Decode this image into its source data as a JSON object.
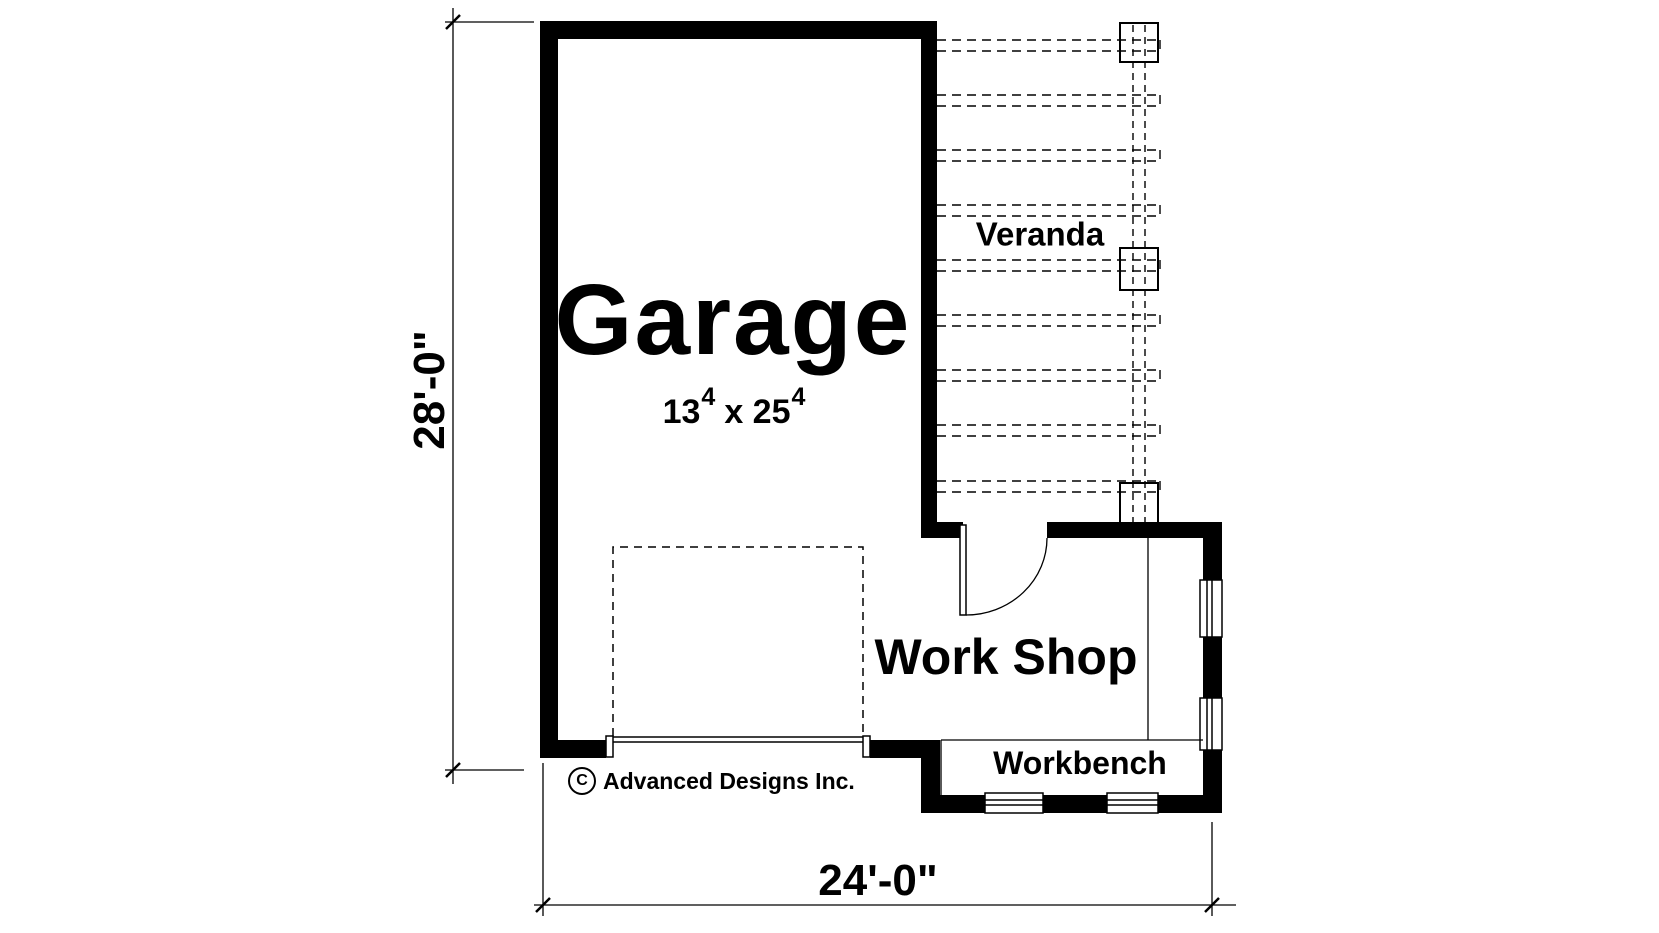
{
  "plan": {
    "garage": {
      "label": "Garage",
      "dim_a": "13",
      "dim_a_sup": "4",
      "dim_mid": "x 25",
      "dim_b_sup": "4"
    },
    "veranda": {
      "label": "Veranda"
    },
    "workshop": {
      "label": "Work Shop"
    },
    "workbench": {
      "label": "Workbench"
    }
  },
  "dimensions": {
    "overall_width": "24'-0\"",
    "overall_depth": "28'-0\""
  },
  "copyright": {
    "symbol": "C",
    "name": "Advanced Designs Inc."
  },
  "colors": {
    "ink": "#000000",
    "paper": "#ffffff"
  }
}
